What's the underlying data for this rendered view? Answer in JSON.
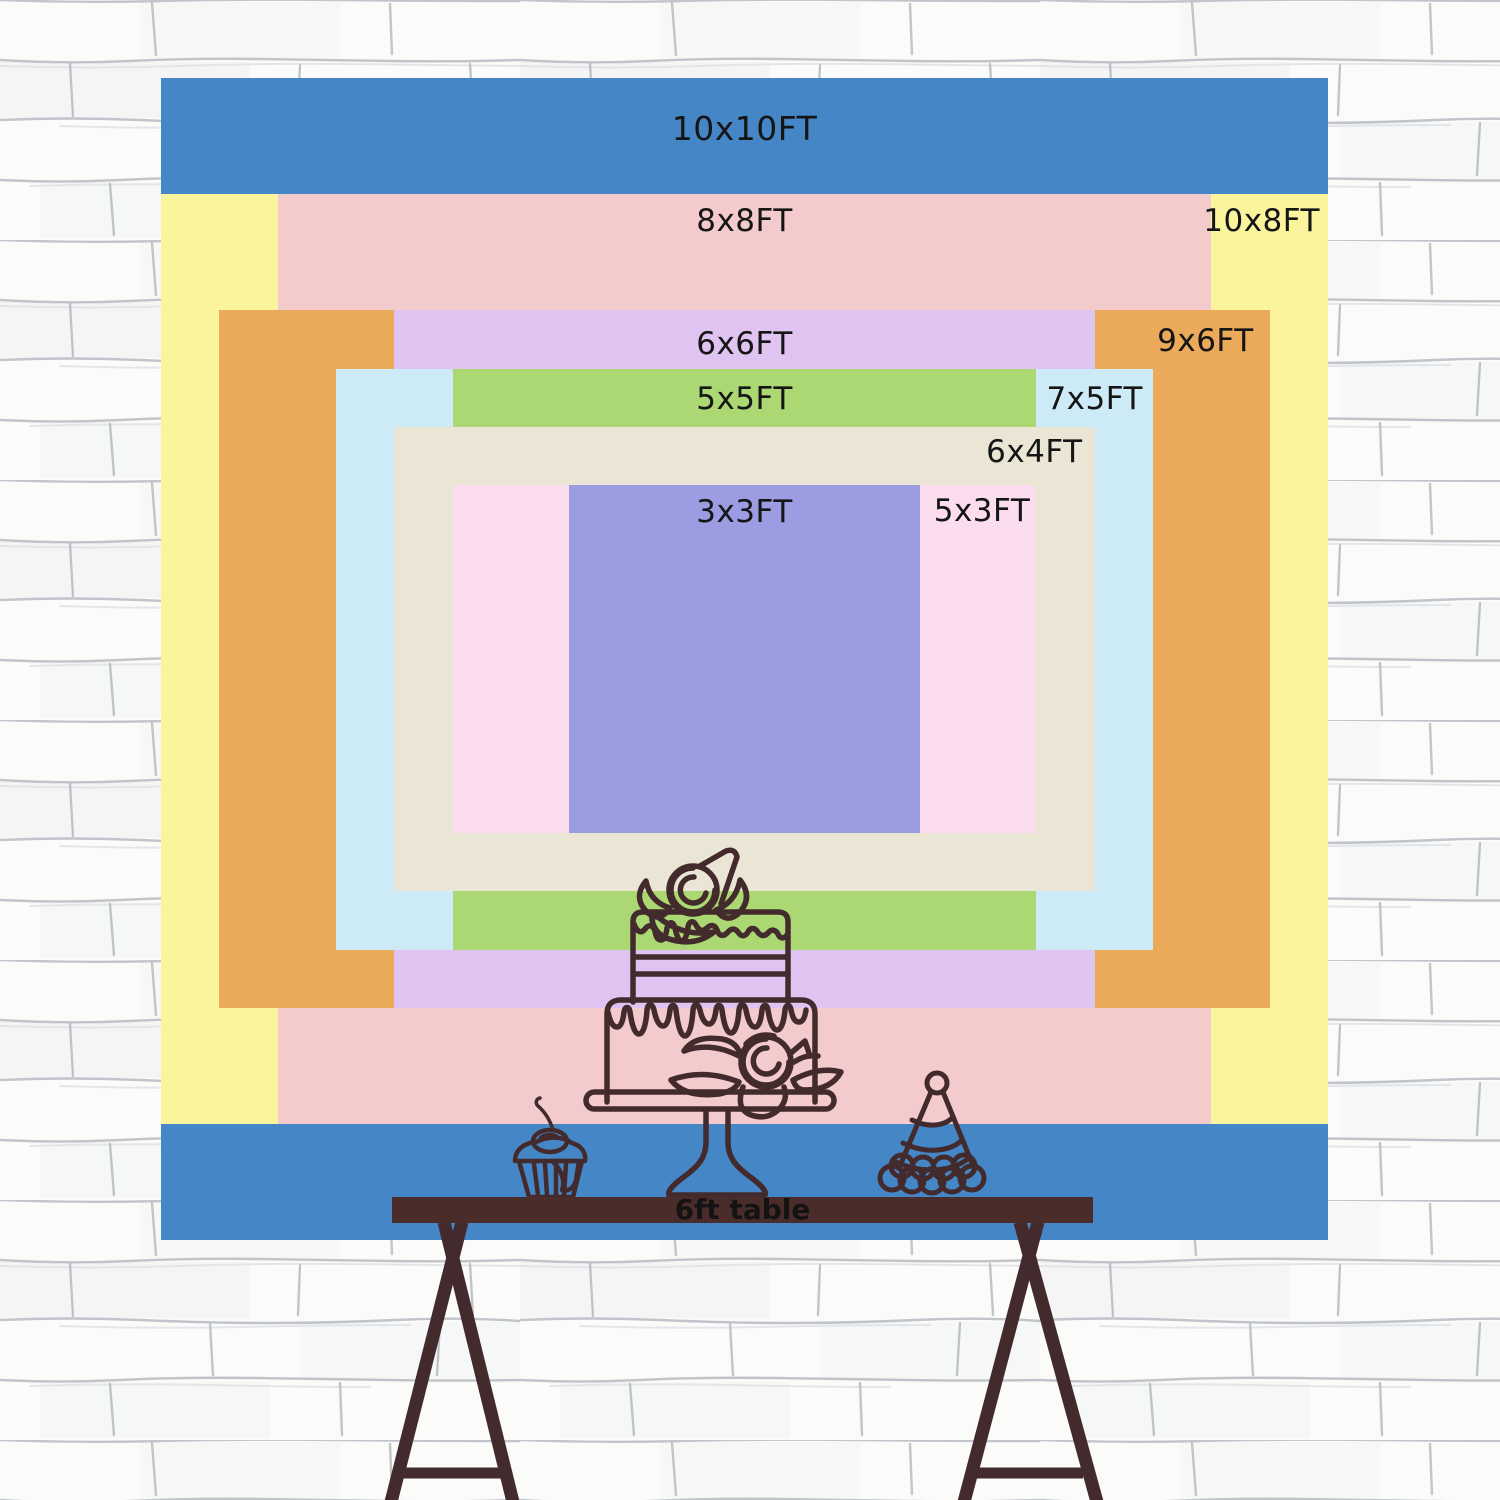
{
  "labels_color": "#151515",
  "background": {
    "wall": "#fbfbf9",
    "mortar": "#b3b8bf",
    "mortar_light": "#dfe2e6",
    "smudge": "#e9ebee"
  },
  "sizes": [
    {
      "id": "10x10",
      "label": "10x10FT",
      "w_ft": 10,
      "h_ft": 10,
      "color": "#4587c6"
    },
    {
      "id": "10x8",
      "label": "10x8FT",
      "w_ft": 10,
      "h_ft": 8,
      "color": "#faf49d"
    },
    {
      "id": "8x8",
      "label": "8x8FT",
      "w_ft": 8,
      "h_ft": 8,
      "color": "#f3cbcc"
    },
    {
      "id": "9x6",
      "label": "9x6FT",
      "w_ft": 9,
      "h_ft": 6,
      "color": "#ebaa59"
    },
    {
      "id": "6x6",
      "label": "6x6FT",
      "w_ft": 6,
      "h_ft": 6,
      "color": "#dfc3f1"
    },
    {
      "id": "7x5",
      "label": "7x5FT",
      "w_ft": 7,
      "h_ft": 5,
      "color": "#cdebf7"
    },
    {
      "id": "5x5",
      "label": "5x5FT",
      "w_ft": 5,
      "h_ft": 5,
      "color": "#abd873"
    },
    {
      "id": "6x4",
      "label": "6x4FT",
      "w_ft": 6,
      "h_ft": 4,
      "color": "#eae5d4"
    },
    {
      "id": "5x3",
      "label": "5x3FT",
      "w_ft": 5,
      "h_ft": 3,
      "color": "#fcddf0"
    },
    {
      "id": "3x3",
      "label": "3x3FT",
      "w_ft": 3,
      "h_ft": 3,
      "color": "#9b9ce2"
    }
  ],
  "table": {
    "label": "6ft table",
    "color": "#4a2d2b",
    "text_color": "#131313"
  },
  "illustrations": {
    "outline_color": "#432a2c",
    "items": [
      "two-tier-cake-icon",
      "cake-stand-icon",
      "cupcake-icon",
      "cherry-icon",
      "party-hat-icon",
      "table-legs"
    ]
  }
}
